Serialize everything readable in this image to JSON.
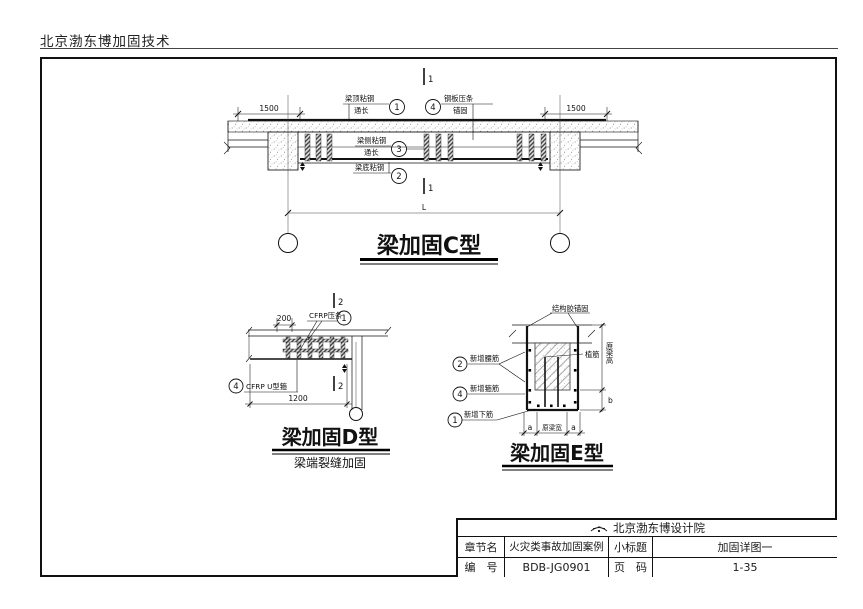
{
  "header": {
    "company": "北京渤东博加固技术"
  },
  "drawings": {
    "c": {
      "title": "梁加固C型",
      "section_marker": "1",
      "dim_left": "1500",
      "dim_right": "1500",
      "dim_span": "L",
      "labels": {
        "top_plate": {
          "num": "1",
          "line1": "梁顶粘钢",
          "line2": "通长"
        },
        "batten": {
          "num": "4",
          "line1": "钢板压条",
          "line2": "锚固"
        },
        "side_plate": {
          "num": "3",
          "line1": "梁侧粘钢",
          "line2": "通长"
        },
        "bottom_plate": {
          "num": "2",
          "line1": "梁底粘钢"
        }
      }
    },
    "d": {
      "title": "梁加固D型",
      "subtitle": "梁端裂缝加固",
      "section_marker": "2",
      "dim_top": "200",
      "dim_bottom": "1200",
      "labels": {
        "strip": {
          "num": "1",
          "text": "CFRP压条"
        },
        "u_wrap": {
          "num": "4",
          "text": "CFRP U型箍"
        }
      }
    },
    "e": {
      "title": "梁加固E型",
      "labels": {
        "adhesive": "结构胶锚固",
        "dowel": "植筋",
        "waist": {
          "num": "2",
          "text": "新增腰筋"
        },
        "stirrup": {
          "num": "4",
          "text": "新增箍筋"
        },
        "bottom": {
          "num": "1",
          "text": "新增下筋"
        }
      },
      "dims": {
        "height_label": "原梁高",
        "b": "b",
        "a_left": "a",
        "width_label": "原梁宽",
        "a_right": "a"
      }
    }
  },
  "titleblock": {
    "company": "北京渤东博设计院",
    "rows": [
      {
        "k1": "章节名",
        "v1": "火灾类事故加固案例",
        "k2": "小标题",
        "v2": "加固详图一"
      },
      {
        "k1": "编　号",
        "v1": "BDB-JG0901",
        "k2": "页　码",
        "v2": "1-35"
      }
    ]
  }
}
